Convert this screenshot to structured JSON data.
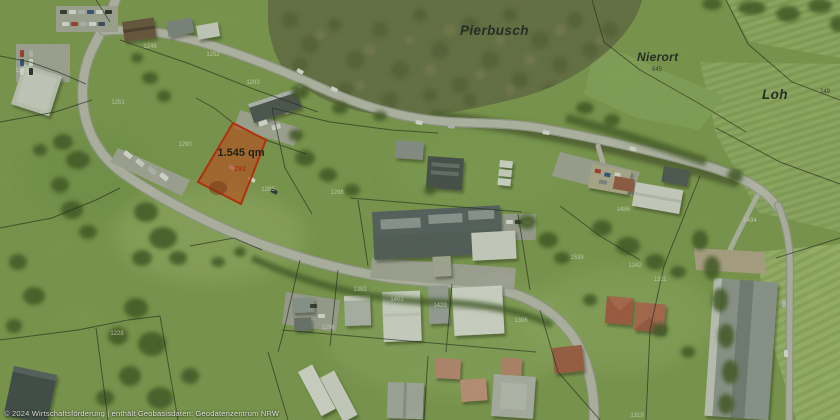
{
  "map": {
    "place_labels": [
      {
        "text": "Pierbusch"
      },
      {
        "text": "Nierort",
        "parcel": "645"
      },
      {
        "text": "Loh",
        "parcel": "249"
      }
    ],
    "highlighted_parcel": {
      "area_label": "1.545 qm",
      "parcel_number": "292",
      "fill_color": "#e8390f",
      "stroke_color": "#d21e00"
    },
    "parcel_numbers": [
      "1246",
      "1252",
      "1251",
      "1293",
      "1290",
      "1285",
      "1298",
      "1382",
      "1402",
      "1429",
      "1296",
      "1396",
      "1538",
      "1342",
      "1494",
      "1486",
      "1311",
      "1319",
      "1228",
      "1301"
    ],
    "attribution": "© 2024 Wirtschaftsförderung | enthält Geobasisdaten: Geodatenzentrum NRW",
    "colors": {
      "grass": "#85a355",
      "forest": "#6a7049",
      "road_inner": "#c9c8c2",
      "boundary": "#141414"
    }
  }
}
